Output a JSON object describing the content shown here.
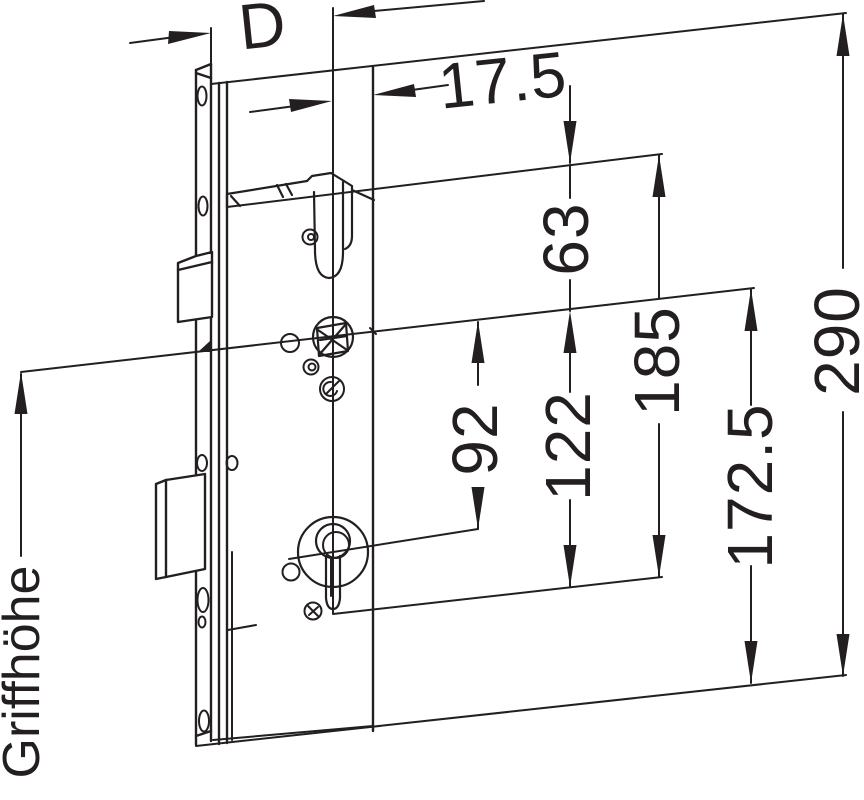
{
  "drawing": {
    "type": "technical-dimension-drawing",
    "subject": "mortise-lock-side-view"
  },
  "dims": {
    "d": "D",
    "t17_5": "17.5",
    "t63": "63",
    "t92": "92",
    "t122": "122",
    "t185": "185",
    "t172_5": "172.5",
    "t290": "290",
    "griffhoehe": "Griffhöhe"
  },
  "colors": {
    "ink": "#231f20",
    "bg": "#ffffff"
  }
}
